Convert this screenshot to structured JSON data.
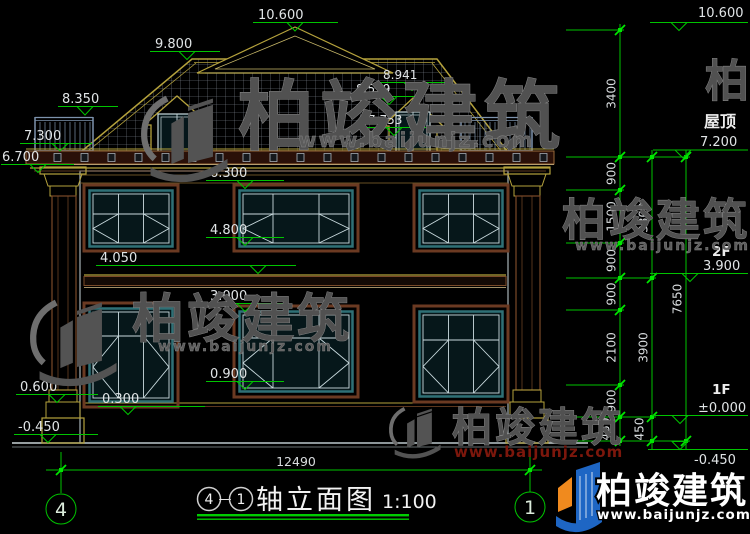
{
  "drawing": {
    "title": {
      "axis_start": "4",
      "dash": "—",
      "axis_end": "1",
      "name": "轴立面图",
      "scale": "1:100"
    },
    "grid": {
      "left_bubble": "4",
      "right_bubble": "1"
    },
    "overall_width": "12490"
  },
  "levels": {
    "peak": "10.600",
    "roof_upper": "9.800",
    "terrace_rail": "8.350",
    "eave_top": "7.300",
    "eave_bottom": "6.700",
    "dormer_peak": "8.941",
    "dormer_eave": "8.559",
    "dormer_sill": "7.753",
    "f2_window_head": "6.300",
    "f2_window_sill": "4.800",
    "belt": "4.050",
    "f1_window_head": "3.000",
    "f1_window_sill": "0.900",
    "plinth_top": "0.600",
    "porch": "0.300",
    "ground": "-0.450"
  },
  "right_panel": {
    "peak_level": "10.600",
    "roof_label": "屋顶",
    "roof_level": "7.200",
    "f2_label": "2F",
    "f2_level": "3.900",
    "f1_label": "1F",
    "f1_level": "±0.000",
    "ground_level": "-0.450",
    "chain_inner": [
      "3400",
      "900",
      "1500",
      "900",
      "900",
      "2100",
      "900",
      "450"
    ],
    "chain_mid": [
      "3300",
      "3900",
      "450"
    ],
    "chain_outer": "7650"
  },
  "watermark": {
    "brand": "柏竣建筑",
    "url": "www.baijunjz.com"
  }
}
